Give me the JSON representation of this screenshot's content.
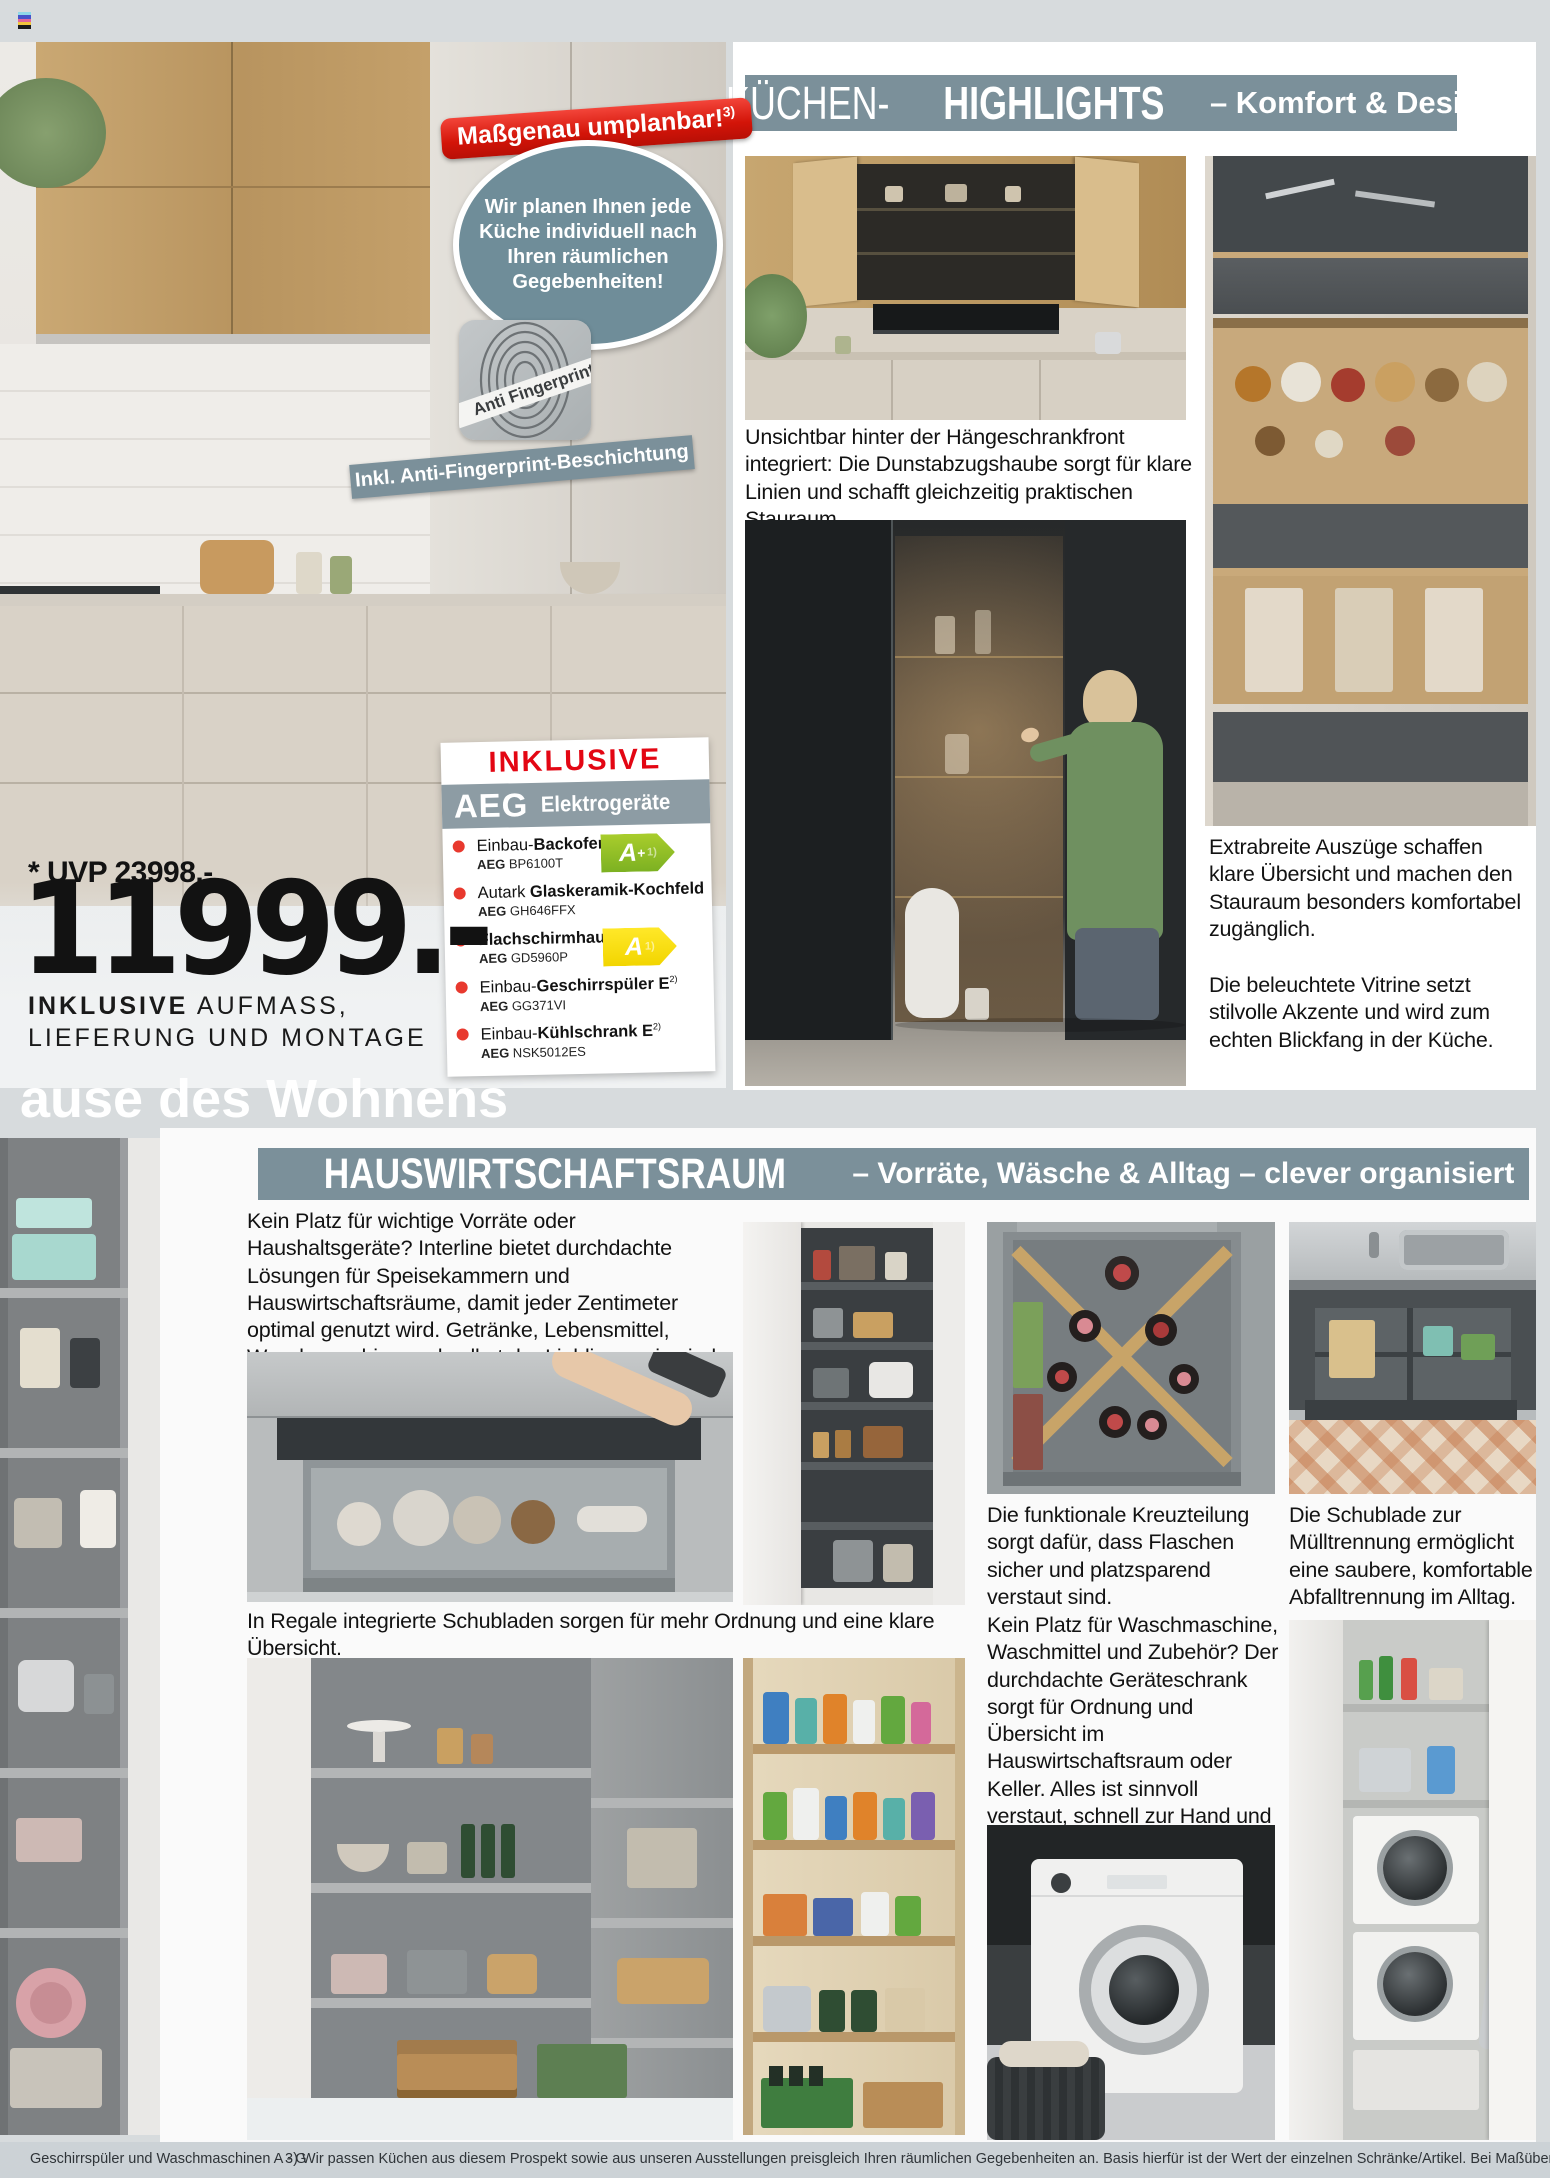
{
  "top": {
    "badge_text": "Maßgenau umplanbar!",
    "badge_sup": "3)",
    "bubble_text": "Wir planen Ihnen jede Küche individuell nach Ihren räumlichen Gegebenheiten!",
    "anti_label": "Anti Fingerprint",
    "banner_text": "Inkl. Anti-Fingerprint-Beschichtung"
  },
  "kitchen_panel": {
    "title_part1": "KÜCHEN-",
    "title_part2": "HIGHLIGHTS",
    "title_rest": "– Komfort & Design",
    "caption_hood": "Unsichtbar hinter der Hängeschrankfront integriert: Die Dunstabzugshaube sorgt für klare Linien und schafft gleichzeitig praktischen Stauraum.",
    "caption_pullouts": "Extrabreite Auszüge schaffen klare Übersicht und machen den Stauraum besonders komfortabel zugänglich.",
    "caption_vitrine": "Die beleuchtete Vitrine setzt stilvolle Akzente und wird zum echten Blickfang in der Küche."
  },
  "aeg": {
    "header": "INKLUSIVE",
    "brand": "AEG",
    "brand_sub": "Elektrogeräte",
    "items": [
      {
        "pre": "Einbau-",
        "bold": "Backofen",
        "sup": "",
        "brand": "AEG",
        "code": "BP6100T",
        "energy_letter": "A",
        "energy_plus": "+",
        "energy_note": "1)"
      },
      {
        "pre": "Autark ",
        "bold": "Glaskeramik-Kochfeld",
        "sup": "",
        "brand": "AEG",
        "code": "GH646FFX"
      },
      {
        "pre": "",
        "bold": "Flachschirmhaube",
        "sup": "",
        "brand": "AEG",
        "code": "GD5960P",
        "energy_letter": "A",
        "energy_plus": "",
        "energy_note": "1)"
      },
      {
        "pre": "Einbau-",
        "bold": "Geschirrspüler E",
        "sup": "2)",
        "brand": "AEG",
        "code": "GG371VI"
      },
      {
        "pre": "Einbau-",
        "bold": "Kühlschrank E",
        "sup": "2)",
        "brand": "AEG",
        "code": "NSK5012ES"
      }
    ]
  },
  "price": {
    "uvp": "* UVP 23998.-",
    "amount": "11999.-",
    "line1_bold": "INKLUSIVE",
    "line1_rest": " AUFMASS,",
    "line2": "LIEFERUNG UND MONTAGE"
  },
  "watermark": "ause des Wohnens",
  "hwr": {
    "title_part1": "HAUSWIRTSCHAFTSRAUM",
    "title_rest": "– Vorräte, Wäsche & Alltag – clever organisiert",
    "intro": "Kein Platz für wichtige Vorräte oder Haushaltsgeräte? Interline bietet durchdachte Lösungen für Speisekammern und Hauswirtschaftsräume, damit jeder Zentimeter optimal genutzt wird. Getränke, Lebensmittel, Waschmaschine und selbst der Lieblingswein sind übersichtlich verstaut und jederzeit griffbereit.",
    "caption_drawers": "In Regale integrierte Schubladen sorgen für mehr Ordnung und eine klare Übersicht.",
    "caption_cross": "Die funktionale Kreuzteilung sorgt dafür, dass Flaschen sicher und platzsparend verstaut sind.",
    "caption_waste": "Die Schublade zur Mülltrennung ermöglicht eine saubere, komfortable Abfalltrennung im Alltag.",
    "caption_laundry": "Kein Platz für Waschmaschine, Waschmittel und Zubehör? Der durchdachte Geräteschrank sorgt für Ordnung und Übersicht im Hauswirtschaftsraum oder Keller. Alles ist sinnvoll verstaut, schnell zur Hand und genau dort, wo es im Alltag gebraucht wird."
  },
  "footer": {
    "left": "Geschirrspüler und Waschmaschinen A - G",
    "note": "3) Wir passen Küchen aus diesem Prospekt sowie aus unseren Ausstellungen preisgleich Ihren räumlichen Gegebenheiten an. Basis hierfür ist der Wert der einzelnen Schränke/Artikel. Bei Maßüberschreitungen kann sich ein Aufpreis ergeben.",
    "colors": {
      "band": "#7b909a",
      "red": "#e30613",
      "page": "#d7dbdd"
    }
  }
}
